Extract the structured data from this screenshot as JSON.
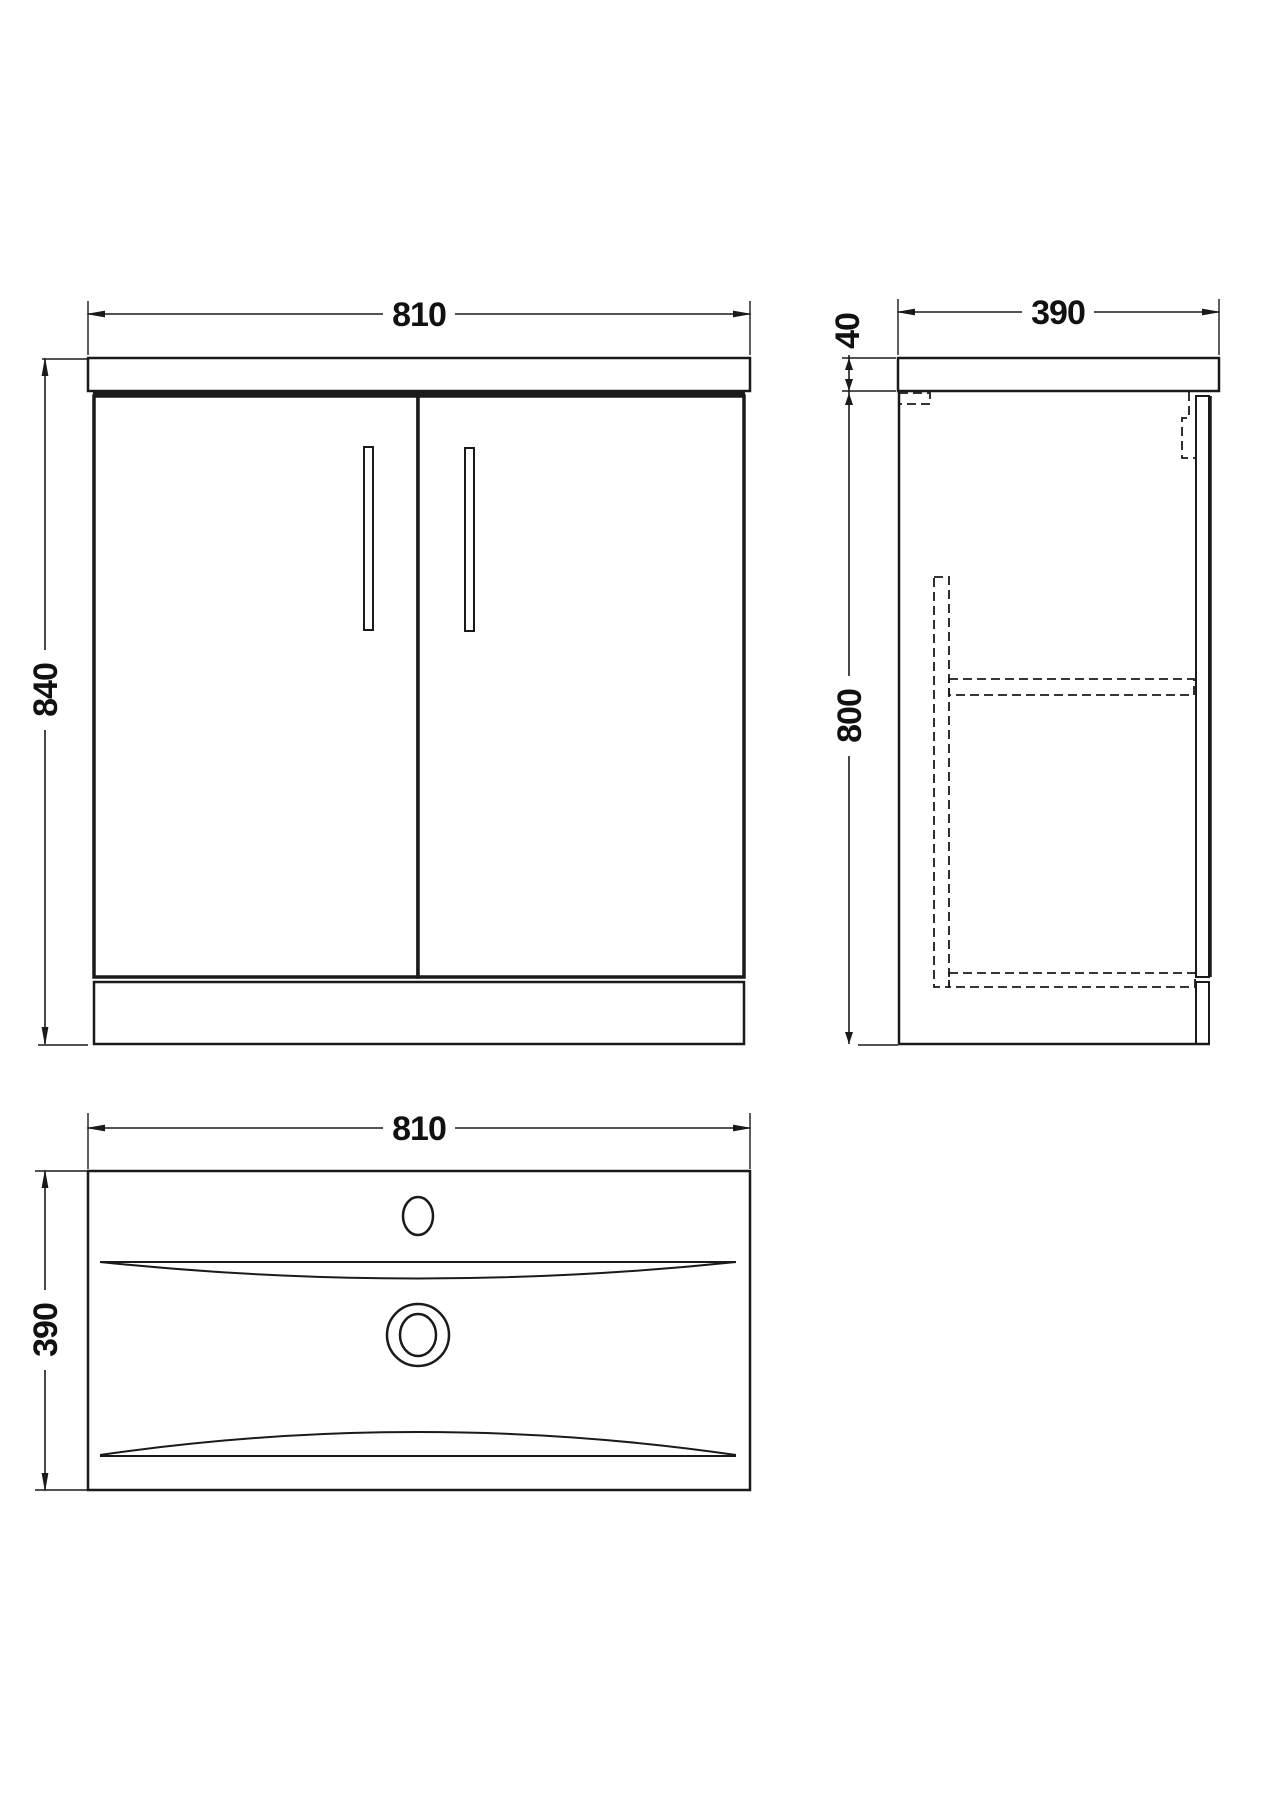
{
  "drawing": {
    "colors": {
      "line": "#1a1a1a",
      "background": "#ffffff"
    },
    "front_view": {
      "width_label": "810",
      "height_label": "840"
    },
    "side_view": {
      "countertop_thickness_label": "40",
      "depth_label": "390",
      "cabinet_height_label": "800"
    },
    "plan_view": {
      "width_label": "810",
      "depth_label": "390"
    }
  }
}
